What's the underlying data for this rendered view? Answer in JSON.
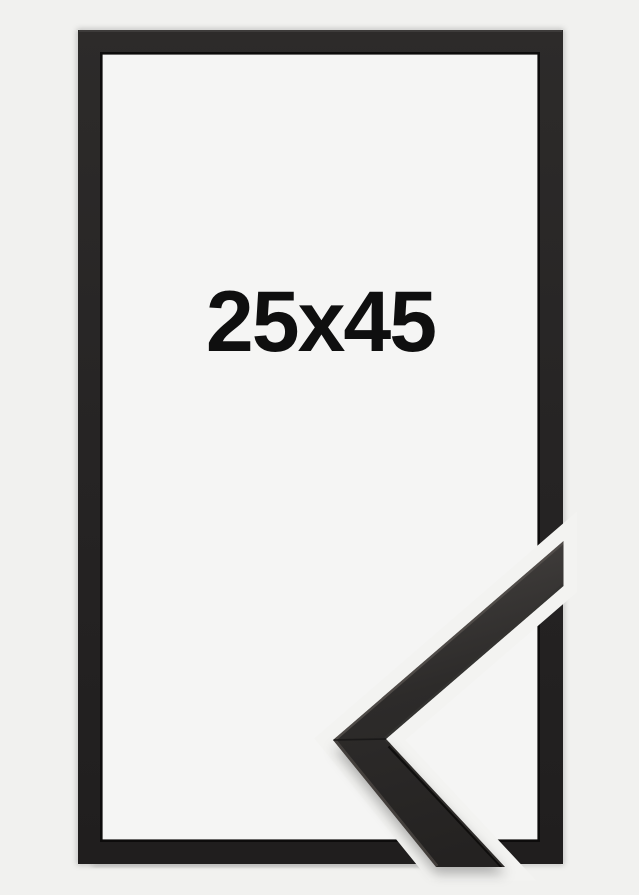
{
  "product": {
    "size_label": "25x45"
  },
  "graphics": {
    "frame": "black-picture-frame-front-view",
    "corner_detail": "mitred-corner-profile-closeup",
    "separator": "diagonal-background-gap"
  },
  "colors": {
    "background": "#f1f1ef",
    "frame_interior": "#f5f5f4",
    "frame_black": "#262424",
    "frame_inner_edge": "#0d0c0c",
    "profile_face": "#2f2d2b",
    "separator_gap": "#f3f3f1",
    "label_text": "#0f0f0f"
  }
}
